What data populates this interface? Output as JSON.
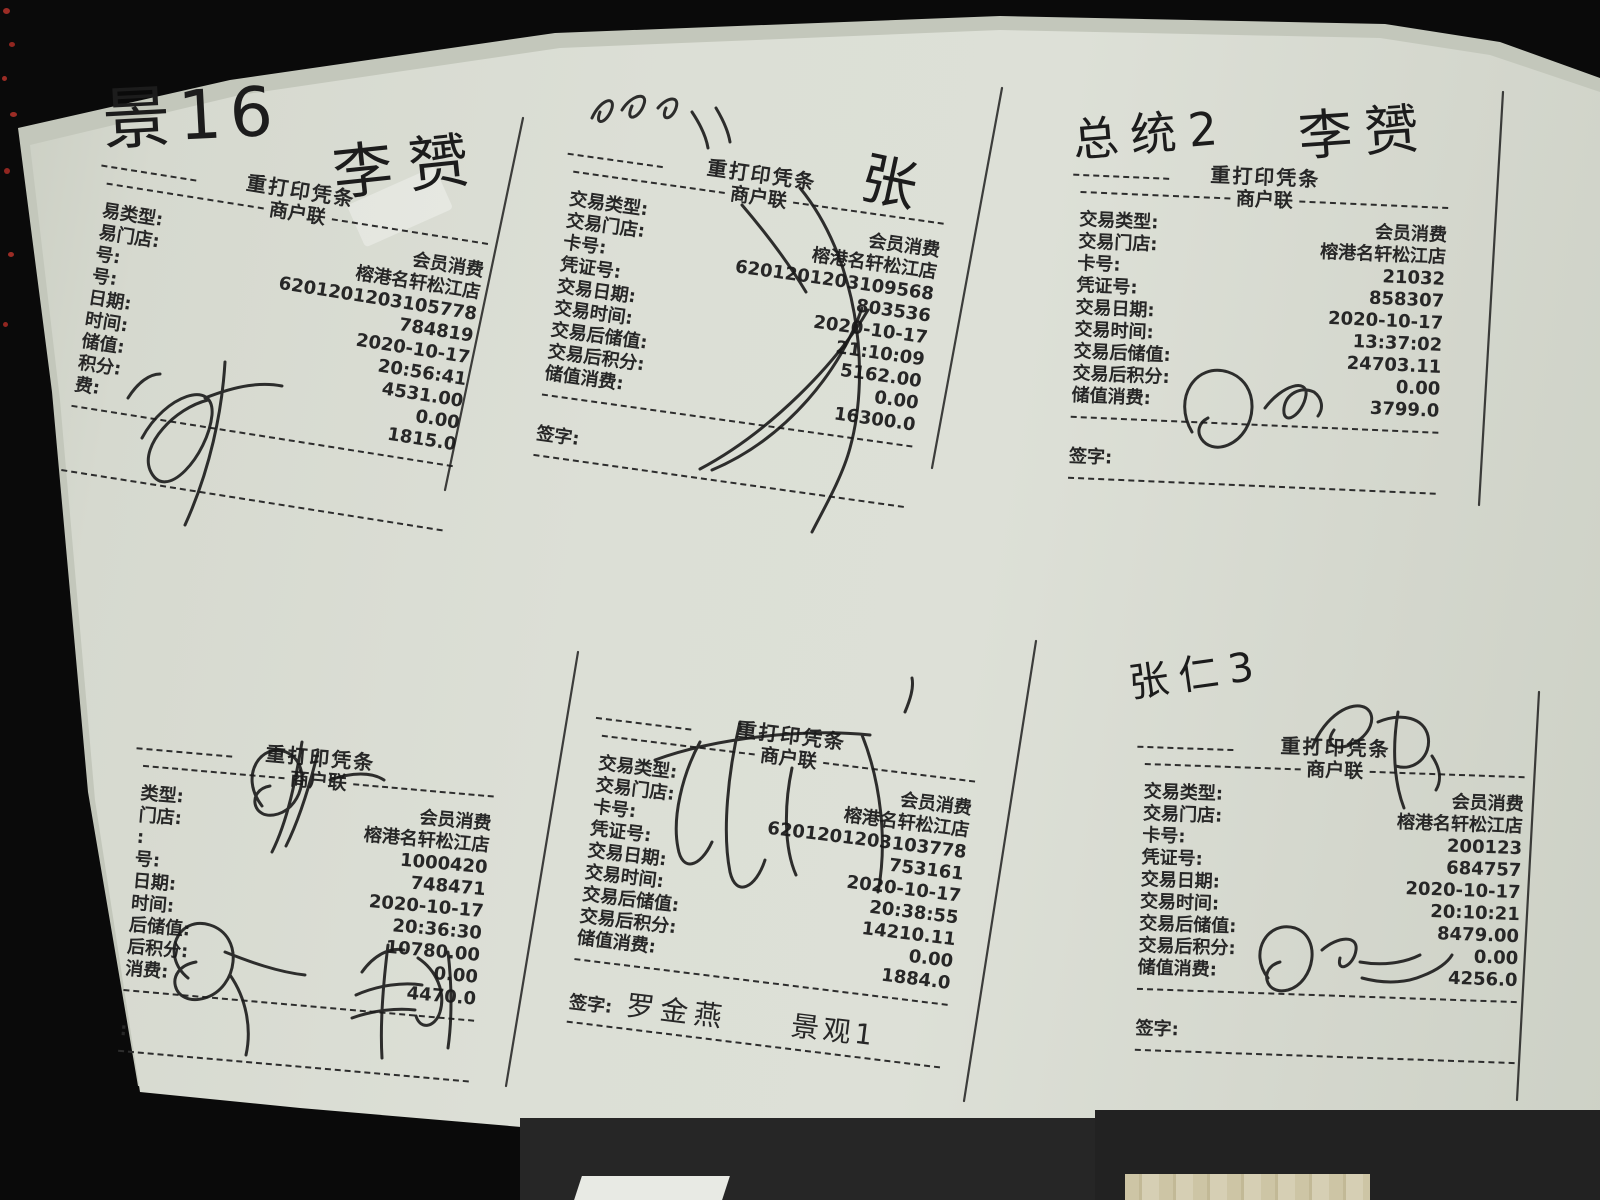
{
  "scene": {
    "background_color": "#0a0a0a",
    "paper_color": "#dcdfd6",
    "ink_color": "#1c1c1c",
    "red_speck_color": "#b5322a",
    "wood_color": "#cdc5a5"
  },
  "handwriting": {
    "note_top_left": "景16",
    "sign_r1_top": "李赟",
    "sign_r2_right": "张",
    "note_r3": "总统2",
    "sign_r3_top": "李赟",
    "note_r6": "张仁3",
    "sign_r5_name": "罗金燕",
    "sign_r5_room": "景观1"
  },
  "receipts": [
    {
      "name": "receipt-top-left",
      "header_title": "重打印凭条",
      "header_subtitle": "商户联",
      "rows": [
        {
          "label": "易类型:",
          "value": "会员消费"
        },
        {
          "label": "易门店:",
          "value": "榕港名轩松江店"
        },
        {
          "label": "号:",
          "value": "6201201203105778"
        },
        {
          "label": "号:",
          "value": "784819"
        },
        {
          "label": "日期:",
          "value": "2020-10-17"
        },
        {
          "label": "时间:",
          "value": "20:56:41"
        },
        {
          "label": "储值:",
          "value": "4531.00"
        },
        {
          "label": "积分:",
          "value": "0.00"
        },
        {
          "label": "费:",
          "value": "1815.0"
        }
      ],
      "sign_label": ""
    },
    {
      "name": "receipt-top-middle",
      "header_title": "重打印凭条",
      "header_subtitle": "商户联",
      "rows": [
        {
          "label": "交易类型:",
          "value": "会员消费"
        },
        {
          "label": "交易门店:",
          "value": "榕港名轩松江店"
        },
        {
          "label": "卡号:",
          "value": "6201201203109568"
        },
        {
          "label": "凭证号:",
          "value": "803536"
        },
        {
          "label": "交易日期:",
          "value": "2020-10-17"
        },
        {
          "label": "交易时间:",
          "value": "21:10:09"
        },
        {
          "label": "交易后储值:",
          "value": "5162.00"
        },
        {
          "label": "交易后积分:",
          "value": "0.00"
        },
        {
          "label": "储值消费:",
          "value": "16300.0"
        }
      ],
      "sign_label": "签字:"
    },
    {
      "name": "receipt-top-right",
      "header_title": "重打印凭条",
      "header_subtitle": "商户联",
      "rows": [
        {
          "label": "交易类型:",
          "value": "会员消费"
        },
        {
          "label": "交易门店:",
          "value": "榕港名轩松江店"
        },
        {
          "label": "卡号:",
          "value": "21032"
        },
        {
          "label": "凭证号:",
          "value": "858307"
        },
        {
          "label": "交易日期:",
          "value": "2020-10-17"
        },
        {
          "label": "交易时间:",
          "value": "13:37:02"
        },
        {
          "label": "交易后储值:",
          "value": "24703.11"
        },
        {
          "label": "交易后积分:",
          "value": "0.00"
        },
        {
          "label": "储值消费:",
          "value": "3799.0"
        }
      ],
      "sign_label": "签字:"
    },
    {
      "name": "receipt-bottom-left",
      "header_title": "重打印凭条",
      "header_subtitle": "商户联",
      "rows": [
        {
          "label": "类型:",
          "value": "会员消费"
        },
        {
          "label": "门店:",
          "value": "榕港名轩松江店"
        },
        {
          "label": ":",
          "value": "1000420"
        },
        {
          "label": "号:",
          "value": "748471"
        },
        {
          "label": "日期:",
          "value": "2020-10-17"
        },
        {
          "label": "时间:",
          "value": "20:36:30"
        },
        {
          "label": "后储值:",
          "value": "10780.00"
        },
        {
          "label": "后积分:",
          "value": "0.00"
        },
        {
          "label": "消费:",
          "value": "4470.0"
        }
      ],
      "sign_label": ":"
    },
    {
      "name": "receipt-bottom-middle",
      "header_title": "重打印凭条",
      "header_subtitle": "商户联",
      "rows": [
        {
          "label": "交易类型:",
          "value": "会员消费"
        },
        {
          "label": "交易门店:",
          "value": "榕港名轩松江店"
        },
        {
          "label": "卡号:",
          "value": "6201201203103778"
        },
        {
          "label": "凭证号:",
          "value": "753161"
        },
        {
          "label": "交易日期:",
          "value": "2020-10-17"
        },
        {
          "label": "交易时间:",
          "value": "20:38:55"
        },
        {
          "label": "交易后储值:",
          "value": "14210.11"
        },
        {
          "label": "交易后积分:",
          "value": "0.00"
        },
        {
          "label": "储值消费:",
          "value": "1884.0"
        }
      ],
      "sign_label": "签字:"
    },
    {
      "name": "receipt-bottom-right",
      "header_title": "重打印凭条",
      "header_subtitle": "商户联",
      "rows": [
        {
          "label": "交易类型:",
          "value": "会员消费"
        },
        {
          "label": "交易门店:",
          "value": "榕港名轩松江店"
        },
        {
          "label": "卡号:",
          "value": "200123"
        },
        {
          "label": "凭证号:",
          "value": "684757"
        },
        {
          "label": "交易日期:",
          "value": "2020-10-17"
        },
        {
          "label": "交易时间:",
          "value": "20:10:21"
        },
        {
          "label": "交易后储值:",
          "value": "8479.00"
        },
        {
          "label": "交易后积分:",
          "value": "0.00"
        },
        {
          "label": "储值消费:",
          "value": "4256.0"
        }
      ],
      "sign_label": "签字:"
    }
  ]
}
